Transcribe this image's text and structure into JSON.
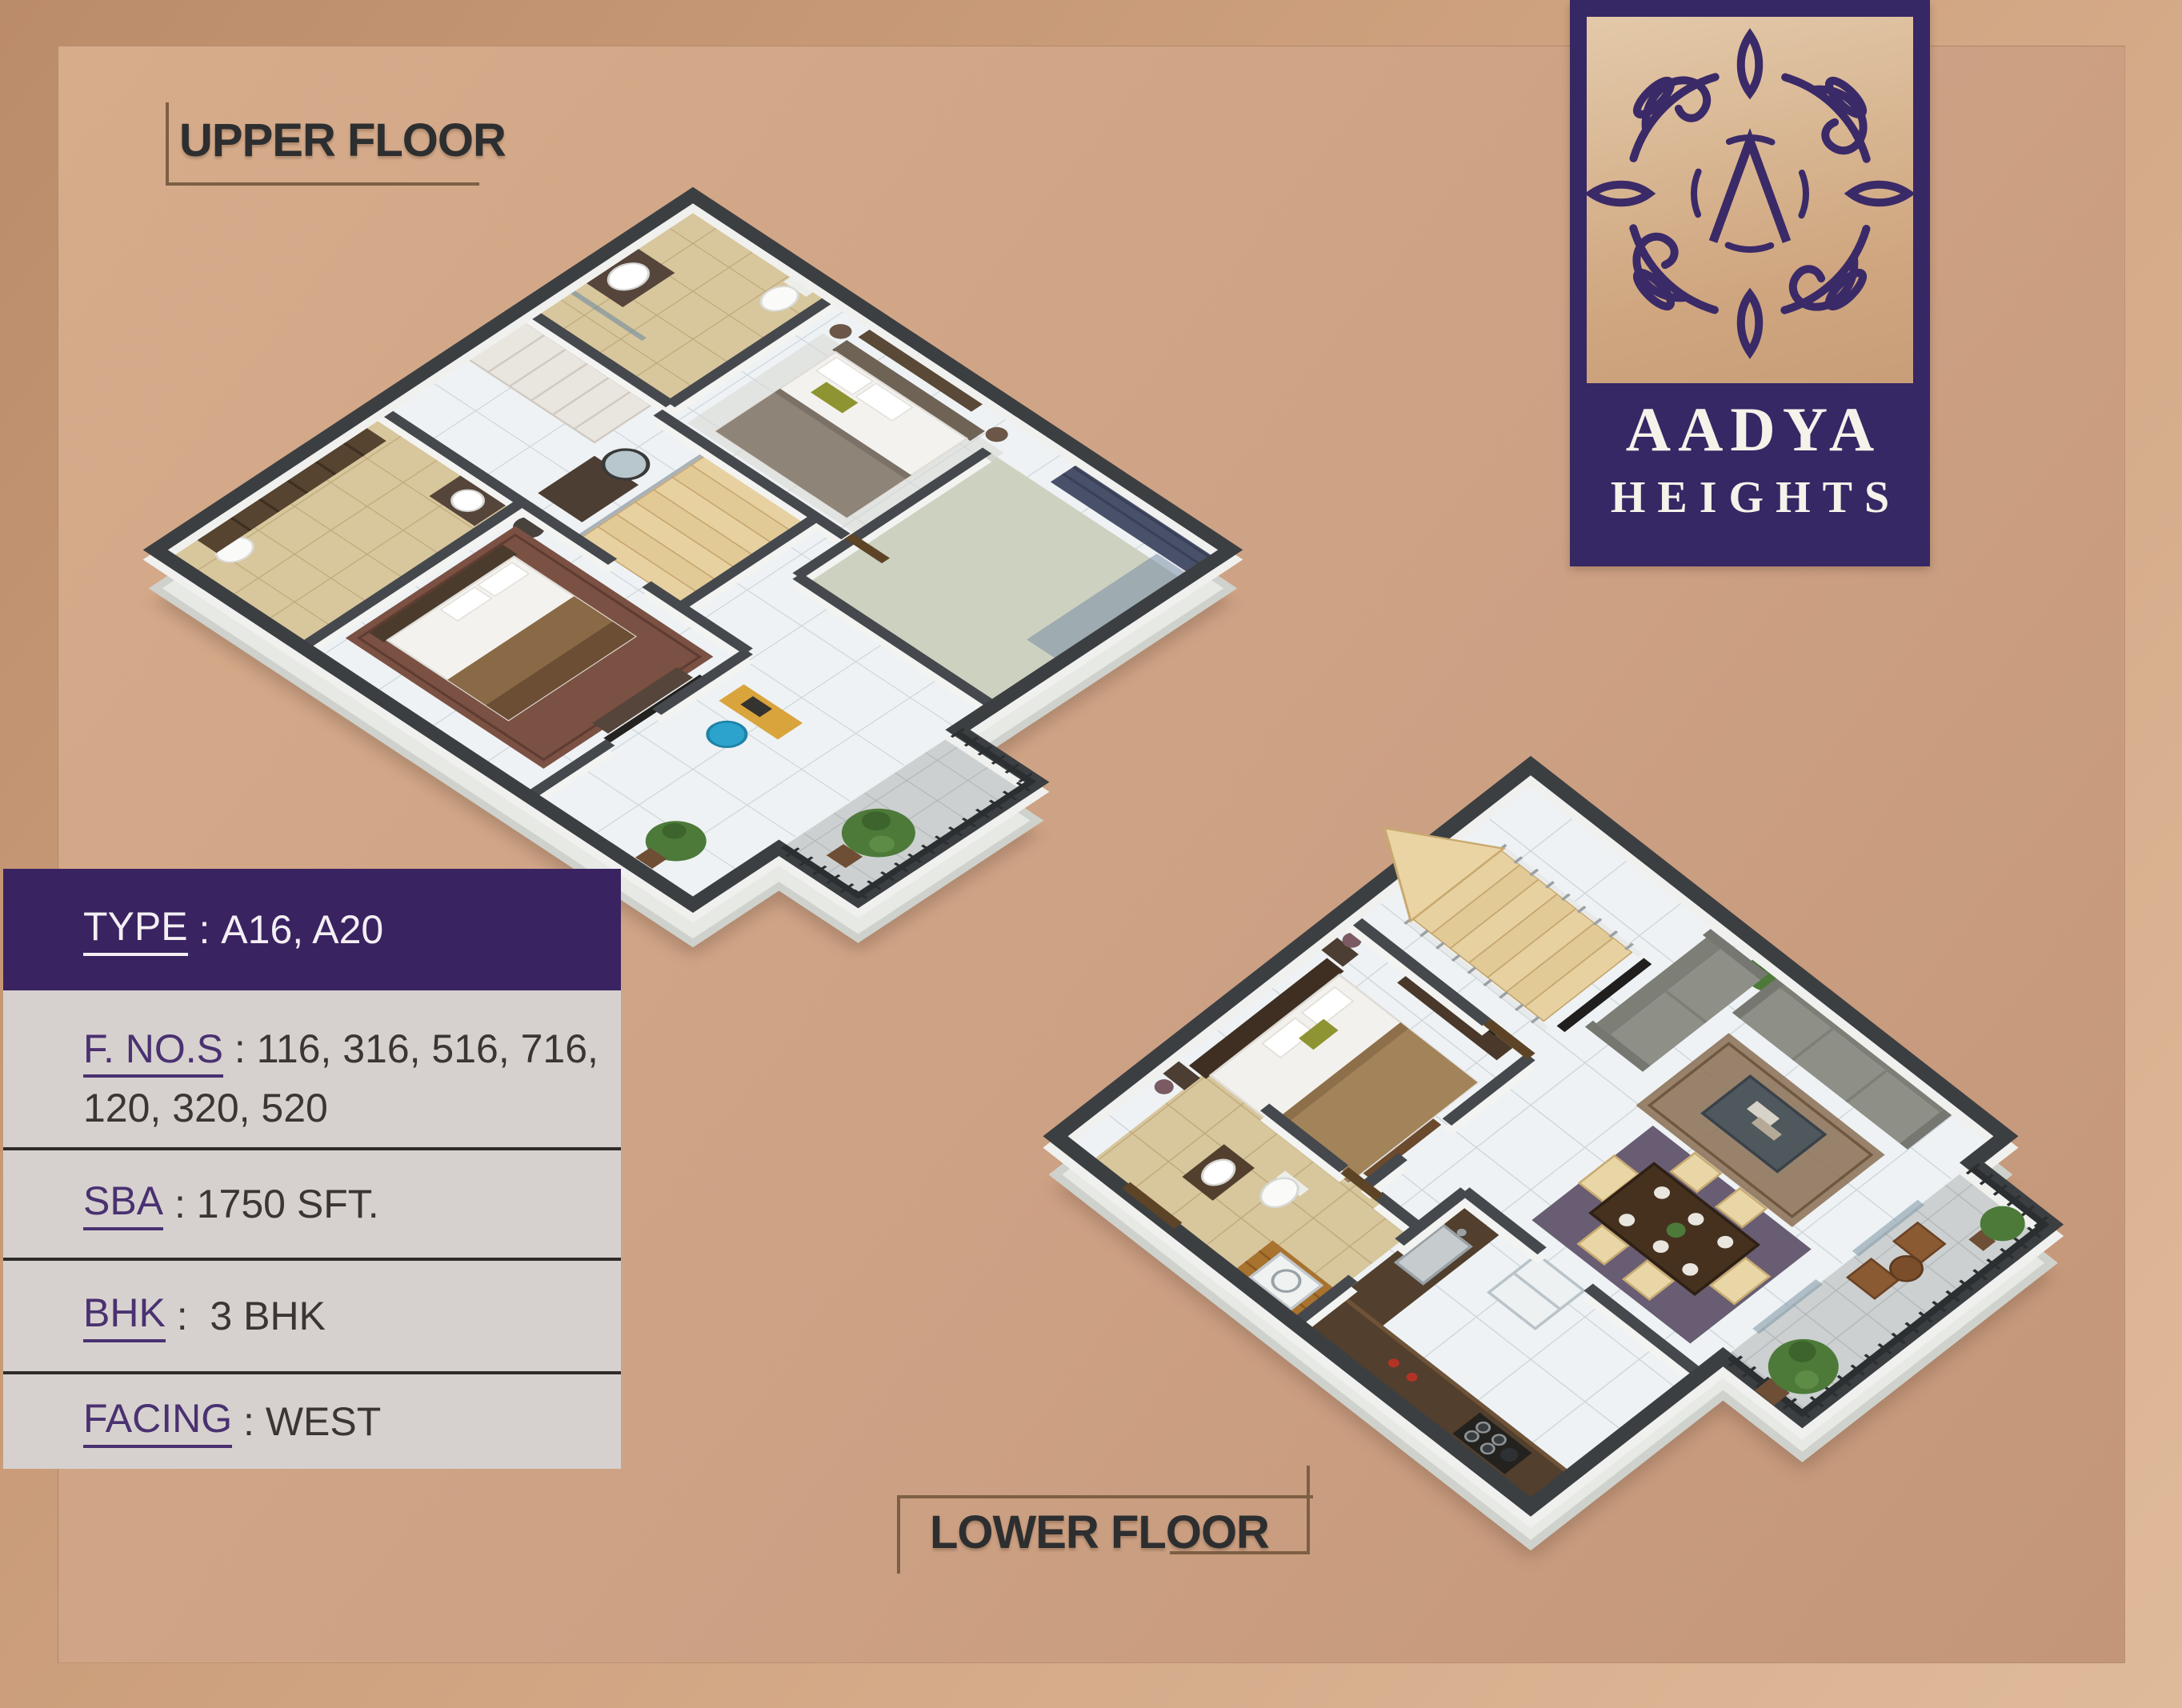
{
  "titles": {
    "upper": "UPPER FLOOR",
    "lower": "LOWER FLOOR"
  },
  "logo": {
    "name": "AADYA",
    "tagline": "HEIGHTS",
    "monogram_icon": "lambda-mandala"
  },
  "info_panel": {
    "rows": [
      {
        "label": "TYPE",
        "separator": " : ",
        "value": "A16, A20"
      },
      {
        "label": "F. NO.S",
        "separator": " : ",
        "value_lines": [
          "116, 316, 516, 716,",
          "120, 320, 520"
        ]
      },
      {
        "label": "SBA",
        "separator": " : ",
        "value": "1750 SFT."
      },
      {
        "label": "BHK",
        "separator": " :  ",
        "value": "3 BHK"
      },
      {
        "label": "FACING",
        "separator": " : ",
        "value": "WEST"
      }
    ]
  },
  "plans": {
    "upper_name": "Upper floor 3D isometric plan",
    "lower_name": "Lower floor 3D isometric plan"
  },
  "colors": {
    "brand_purple": "#362765",
    "panel_purple": "#3a2361",
    "panel_gray": "#d6d1ce",
    "page_tan": "#cda184",
    "bracket_accent": "#7d5f45",
    "wall_dark": "#3b3f42",
    "floor_marble": "#eef2f4",
    "floor_beige": "#d8c69c",
    "stairs_tan": "#e7d1a1",
    "plant_green": "#4d7a39",
    "sofa_gray": "#8e9088"
  }
}
